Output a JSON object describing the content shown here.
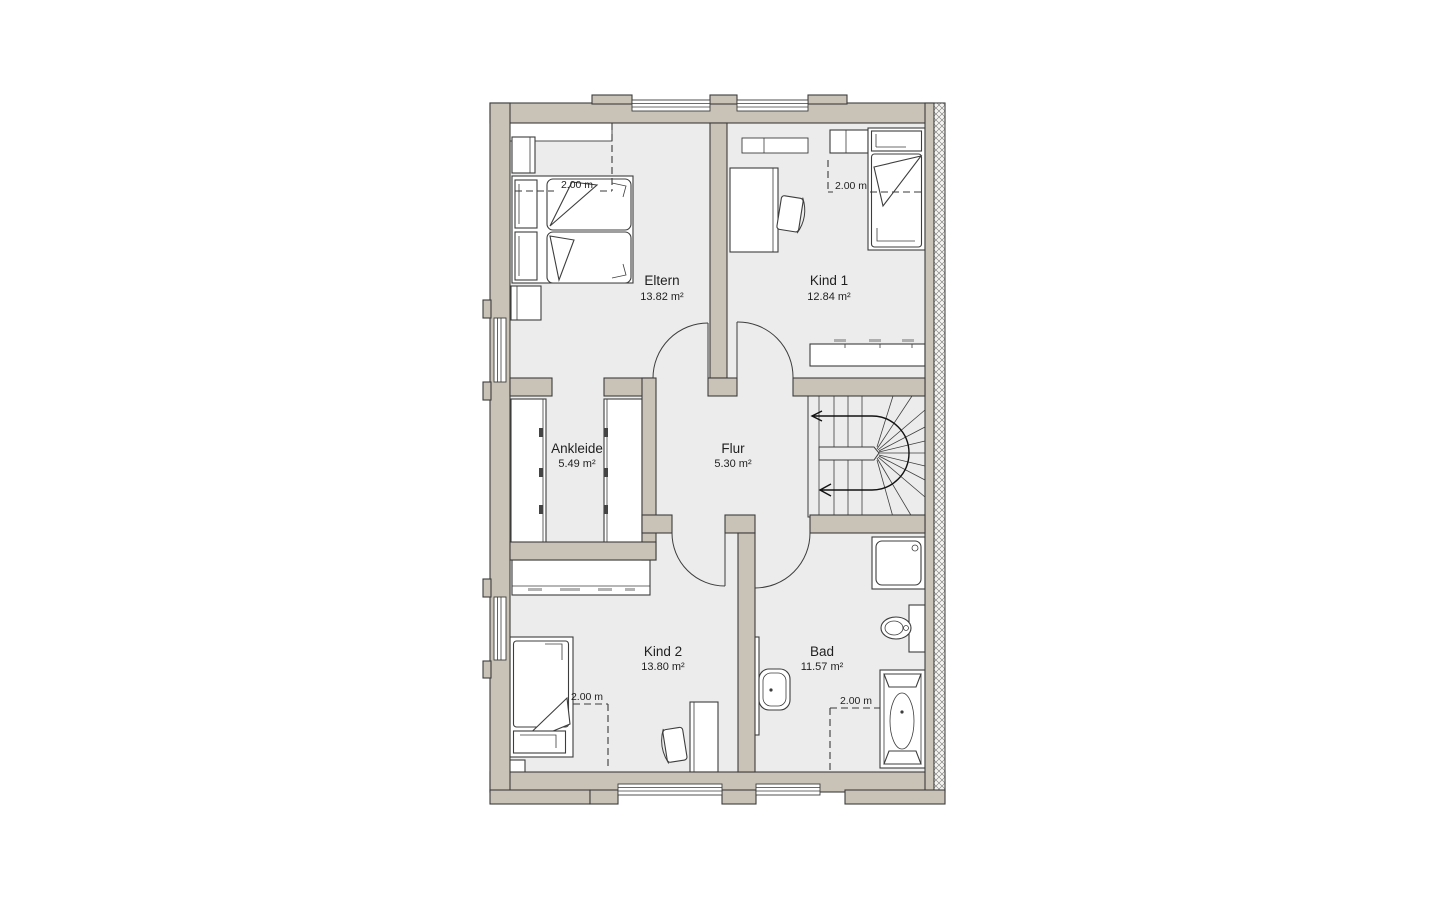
{
  "page": {
    "background": "#ffffff"
  },
  "plan": {
    "rooms": [
      {
        "id": "eltern",
        "name": "Eltern",
        "area": "13.82 m²"
      },
      {
        "id": "kind1",
        "name": "Kind 1",
        "area": "12.84 m²"
      },
      {
        "id": "ankleide",
        "name": "Ankleide",
        "area": "5.49 m²"
      },
      {
        "id": "flur",
        "name": "Flur",
        "area": "5.30 m²"
      },
      {
        "id": "kind2",
        "name": "Kind 2",
        "area": "13.80 m²"
      },
      {
        "id": "bad",
        "name": "Bad",
        "area": "11.57 m²"
      }
    ],
    "dimension_labels": [
      {
        "room": "Eltern",
        "text": "2.00 m"
      },
      {
        "room": "Kind 1",
        "text": "2.00 m"
      },
      {
        "room": "Kind 2",
        "text": "2.00 m"
      },
      {
        "room": "Bad",
        "text": "2.00 m"
      }
    ],
    "colors": {
      "wall": "#c9c3b7",
      "floor": "#ececec",
      "outline": "#3d3d3d",
      "hatch_background": "#f4f3f0"
    }
  }
}
